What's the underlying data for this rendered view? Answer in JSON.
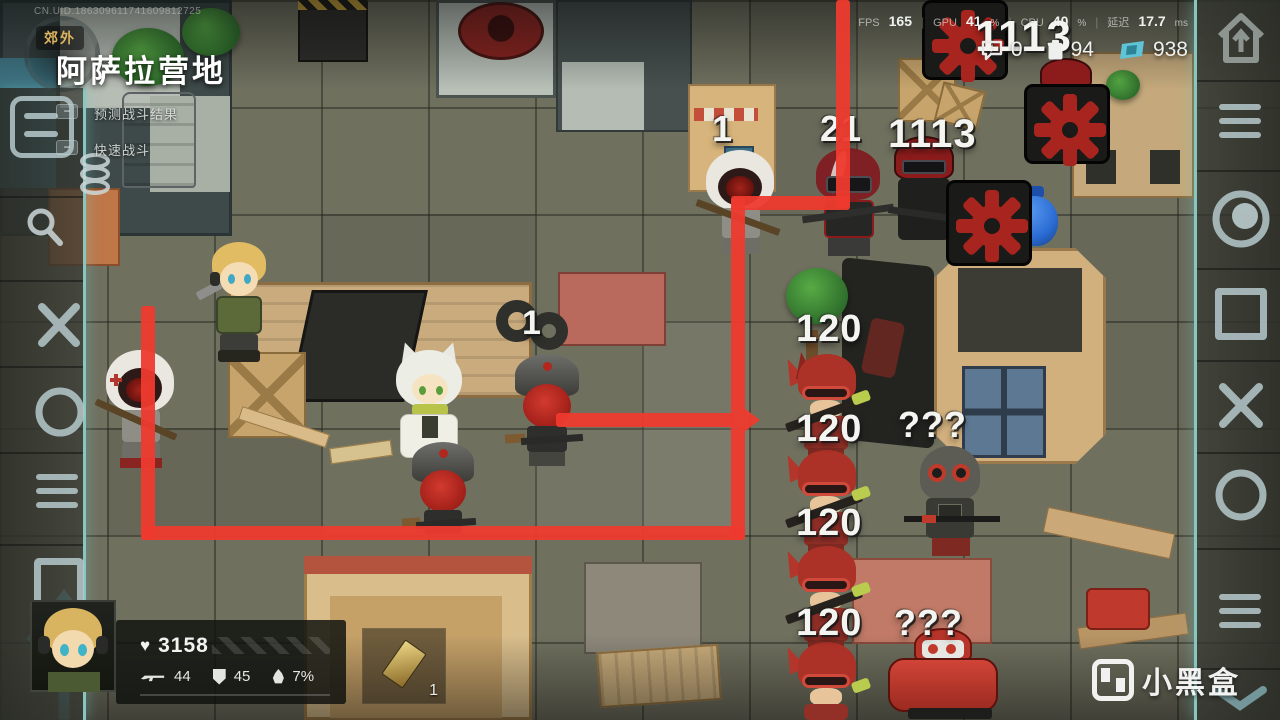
{
  "meta": {
    "uid": "CN.UID.186309611741609812725",
    "area_tag": "郊外",
    "title": "阿萨拉营地"
  },
  "left_panel": {
    "minus": "−",
    "predict_label": "预测战斗结果",
    "quick_label": "快速战斗"
  },
  "perf": {
    "fps_label": "FPS",
    "fps": "165",
    "gpu_label": "GPU",
    "gpu": "41",
    "cpu_label": "CPU",
    "cpu": "40",
    "pct": "%",
    "latency_label": "延迟",
    "latency": "17.7",
    "latency_unit": "ms",
    "sep": "|"
  },
  "currency": {
    "chat": "0",
    "energy": "94",
    "cash": "938"
  },
  "player": {
    "hp": "3158",
    "atk": "44",
    "def": "45",
    "burn": "7%"
  },
  "item_slot": {
    "count": "1"
  },
  "map_labels": [
    {
      "text": "1113"
    },
    {
      "text": "1113"
    },
    {
      "text": "1"
    },
    {
      "text": "21"
    },
    {
      "text": "1"
    },
    {
      "text": "120"
    },
    {
      "text": "120"
    },
    {
      "text": "120"
    },
    {
      "text": "120"
    },
    {
      "text": "???"
    },
    {
      "text": "???"
    }
  ],
  "watermark": {
    "text": "小黑盒"
  },
  "colors": {
    "path_red": "#ee3a2e",
    "edge_teal": "#92d6d0",
    "gold": "#dcb35e"
  }
}
